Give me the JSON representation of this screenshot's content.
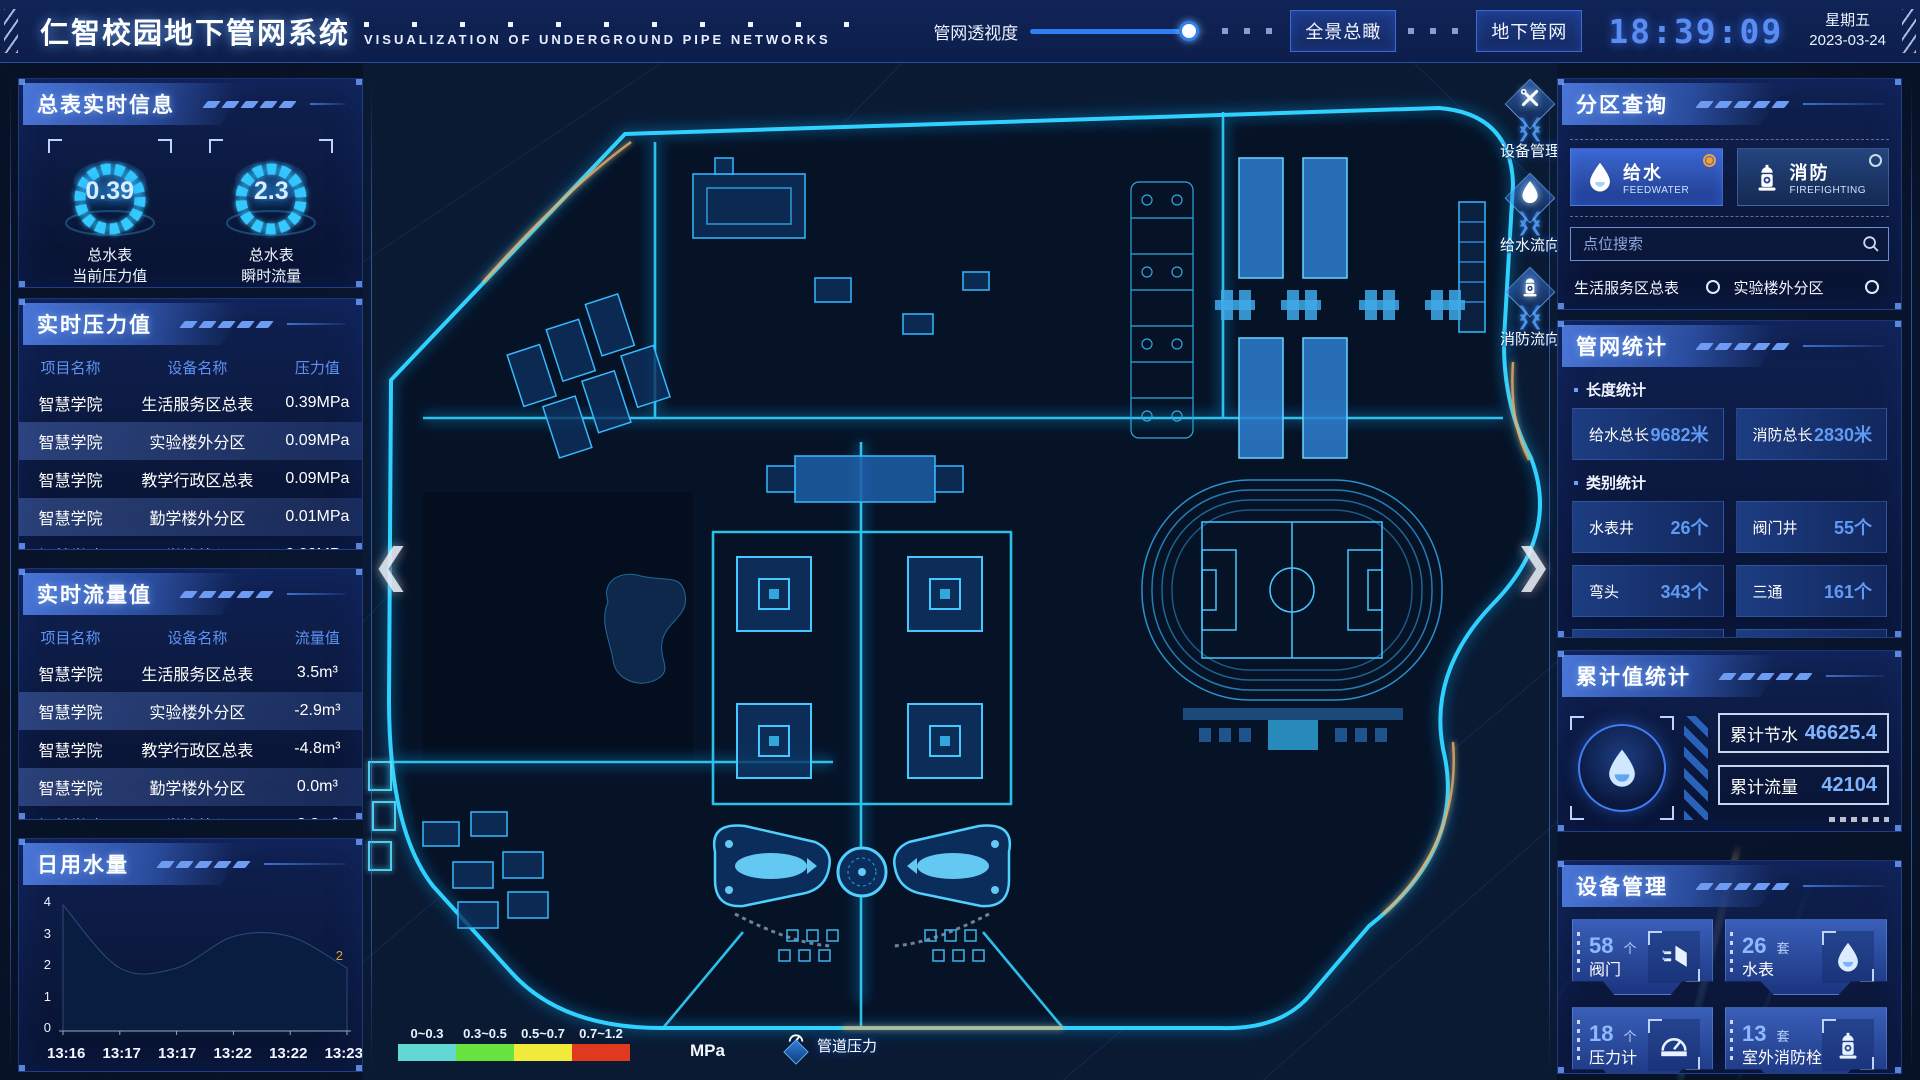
{
  "header": {
    "title": "仁智校园地下管网系统",
    "subtitle": "VISUALIZATION OF UNDERGROUND PIPE NETWORKS",
    "transparency_label": "管网透视度",
    "buttons": [
      {
        "label": "全景总瞰"
      },
      {
        "label": "地下管网"
      }
    ],
    "clock": {
      "time": "18:39:09",
      "weekday": "星期五",
      "date": "2023-03-24"
    }
  },
  "left": {
    "master_panel": {
      "title": "总表实时信息",
      "gauges": [
        {
          "value": "0.39",
          "label_line1": "总水表",
          "label_line2": "当前压力值"
        },
        {
          "value": "2.3",
          "label_line1": "总水表",
          "label_line2": "瞬时流量"
        }
      ]
    },
    "pressure_panel": {
      "title": "实时压力值",
      "headers": [
        "项目名称",
        "设备名称",
        "压力值"
      ],
      "rows": [
        {
          "project": "智慧学院",
          "device": "生活服务区总表",
          "value": "0.39MPa"
        },
        {
          "project": "智慧学院",
          "device": "实验楼外分区",
          "value": "0.09MPa"
        },
        {
          "project": "智慧学院",
          "device": "教学行政区总表",
          "value": "0.09MPa"
        },
        {
          "project": "智慧学院",
          "device": "勤学楼外分区",
          "value": "0.01MPa"
        },
        {
          "project": "智慧学院",
          "device": "砺学楼外分区",
          "value": "0.00MPa"
        }
      ]
    },
    "flow_panel": {
      "title": "实时流量值",
      "headers": [
        "项目名称",
        "设备名称",
        "流量值"
      ],
      "rows": [
        {
          "project": "智慧学院",
          "device": "生活服务区总表",
          "value": "3.5m³"
        },
        {
          "project": "智慧学院",
          "device": "实验楼外分区",
          "value": "-2.9m³"
        },
        {
          "project": "智慧学院",
          "device": "教学行政区总表",
          "value": "-4.8m³"
        },
        {
          "project": "智慧学院",
          "device": "勤学楼外分区",
          "value": "0.0m³"
        },
        {
          "project": "智慧学院",
          "device": "砺学楼外分区",
          "value": "2.3m³"
        }
      ]
    },
    "daily_panel": {
      "title": "日用水量"
    }
  },
  "chart_data": {
    "type": "area",
    "title": "日用水量",
    "x": [
      "13:16",
      "13:17",
      "13:17",
      "13:22",
      "13:22",
      "13:23"
    ],
    "values": [
      4,
      2,
      2,
      3,
      3,
      2
    ],
    "yticks": [
      0,
      1,
      2,
      3,
      4
    ],
    "ylim": [
      0,
      4
    ],
    "grid": false,
    "last_label": "2",
    "last_label_color": "#d9a430",
    "area_color": "#0a1e40"
  },
  "right": {
    "zone_panel": {
      "title": "分区查询",
      "tabs": [
        {
          "label": "给水",
          "sub": "FEEDWATER",
          "selected": true
        },
        {
          "label": "消防",
          "sub": "FIREFIGHTING",
          "selected": false
        }
      ],
      "search_placeholder": "点位搜索",
      "items": [
        "生活服务区总表",
        "实验楼外分区",
        "教学行政区总表",
        "勤学楼外分区",
        "砺学楼外分区",
        "宿舍区泵房"
      ]
    },
    "stats_panel": {
      "title": "管网统计",
      "length_title": "长度统计",
      "length_stats": [
        {
          "label": "给水总长",
          "value": "9682米"
        },
        {
          "label": "消防总长",
          "value": "2830米"
        }
      ],
      "category_title": "类别统计",
      "category_stats": [
        {
          "label": "水表井",
          "value": "26个"
        },
        {
          "label": "阀门井",
          "value": "55个"
        },
        {
          "label": "弯头",
          "value": "343个"
        },
        {
          "label": "三通",
          "value": "161个"
        }
      ]
    },
    "cumulative_panel": {
      "title": "累计值统计",
      "stats": [
        {
          "label": "累计节水",
          "value": "46625.4"
        },
        {
          "label": "累计流量",
          "value": "42104"
        }
      ]
    },
    "device_panel": {
      "title": "设备管理",
      "cards": [
        {
          "count": "58",
          "unit": "个",
          "label": "阀门",
          "icon": "valve-icon"
        },
        {
          "count": "26",
          "unit": "套",
          "label": "水表",
          "icon": "water-meter-icon"
        },
        {
          "count": "18",
          "unit": "个",
          "label": "压力计",
          "icon": "pressure-gauge-icon"
        },
        {
          "count": "13",
          "unit": "套",
          "label": "室外消防栓",
          "icon": "hydrant-icon"
        }
      ]
    }
  },
  "map": {
    "tools": [
      {
        "label": "设备管理",
        "icon": "wrench-icon"
      },
      {
        "label": "给水流向",
        "icon": "water-drop-icon"
      },
      {
        "label": "消防流向",
        "icon": "hydrant-icon"
      }
    ],
    "legend": {
      "ranges": [
        "0~0.3",
        "0.3~0.5",
        "0.5~0.7",
        "0.7~1.2"
      ],
      "colors": [
        "#62d8d4",
        "#68e23e",
        "#f2ea3a",
        "#e0391f"
      ],
      "unit": "MPa",
      "label": "管道压力"
    }
  },
  "colors": {
    "accent": "#2e7ff2",
    "pipe_cyan": "#2fd2ff",
    "radio_selected": "#f0a13a",
    "value_blue": "#5f9bf5"
  }
}
